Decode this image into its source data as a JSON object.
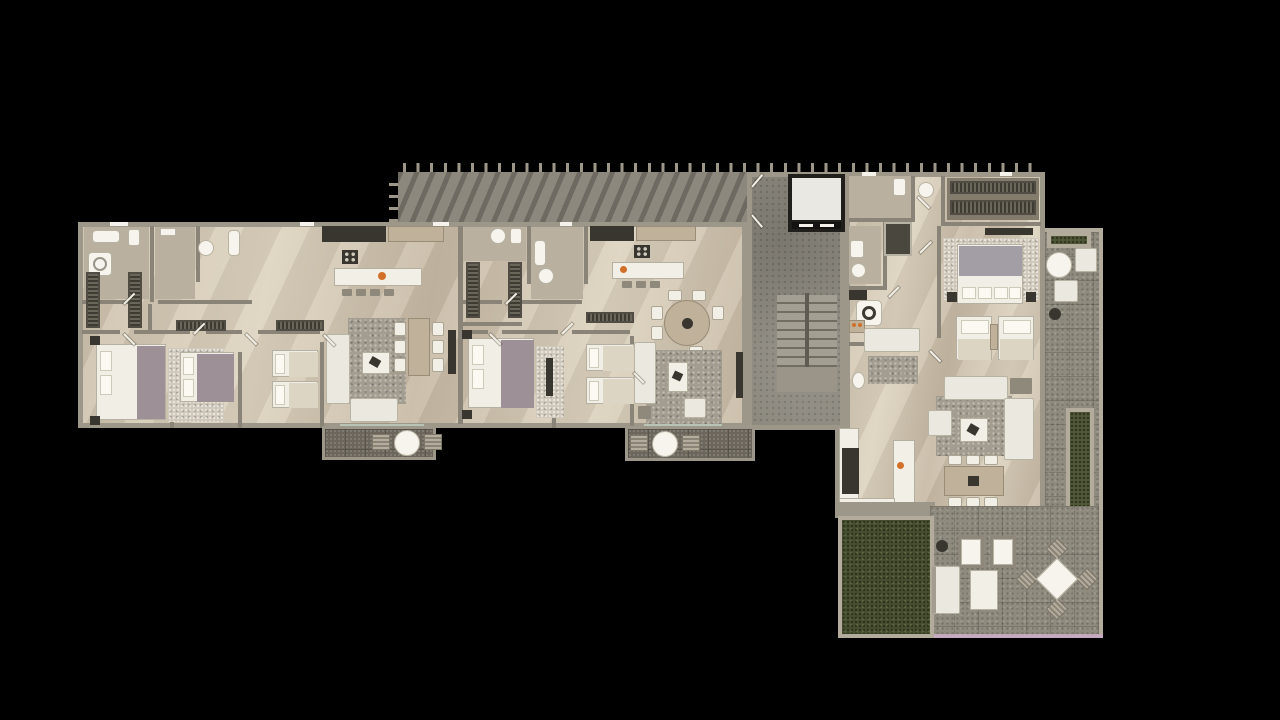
{
  "scene": {
    "description": "Top-down 3D architectural render of a residential floor level on a black background: a long left wing with two apartments, a central concrete stair hall with elevator, a pergola-covered corridor, and a large corner apartment with wrap-around terrace, lawn and planters.",
    "background": "#000000"
  },
  "palette": {
    "bg": "#000000",
    "wall": "#9d978a",
    "wallin": "#8a8478",
    "tile": "#b9b0a0",
    "concrete": "#8c887e",
    "pavers": "#8f8b7f",
    "balc": "#6b665b",
    "grass": "#474f31",
    "planter": "#505839",
    "curb": "#b3ab9b",
    "rug": "#a39d90",
    "ruglight": "#cfc8ba",
    "sofa": "#ebe8df",
    "bedwhite": "#f1eee6",
    "mauve": "#9d9097",
    "duvet": "#a39da6",
    "appl": "#38362f",
    "woodfurn": "#c0b29a",
    "accent": "#d2702a",
    "glass": "#c2cfc0",
    "pinkedge": "#c4a9bf",
    "elevcab": "#eae8e2",
    "elevframe": "#201f1c"
  },
  "building": {
    "left_wing": {
      "units": [
        {
          "name": "unit-a",
          "visible_features": [
            "bathroom-with-tub",
            "washer",
            "walk-in-closet",
            "double-bed",
            "mauve-accent-bed",
            "twin-beds",
            "kitchen-island-with-stools",
            "l-shaped-sofa",
            "area-rug",
            "dining-table-six-chairs",
            "balcony-with-round-table"
          ]
        },
        {
          "name": "unit-b",
          "visible_features": [
            "bathroom",
            "walk-in-closet",
            "double-bed",
            "twin-beds",
            "kitchen-island-with-stools",
            "round-dining-table-six-chairs",
            "sofa-and-armchair",
            "area-rug",
            "balcony-with-round-table"
          ]
        }
      ]
    },
    "core": {
      "visible_features": [
        "elevator",
        "u-shaped-staircase",
        "concrete-hall",
        "pergola-slat-roof-corridor"
      ]
    },
    "right_unit": {
      "visible_features": [
        "entry-hall",
        "wardrobe-run",
        "master-bed",
        "twin-lounge-beds",
        "bathrooms",
        "shower",
        "laundry-washer",
        "den-sofa",
        "l-shaped-sofa",
        "dining-table-six-chairs",
        "kitchen-island",
        "side-terrace-bistro-set",
        "grill",
        "long-planter",
        "lawn",
        "lounge-chairs",
        "outdoor-sofa",
        "diamond-outdoor-dining-set"
      ]
    }
  }
}
